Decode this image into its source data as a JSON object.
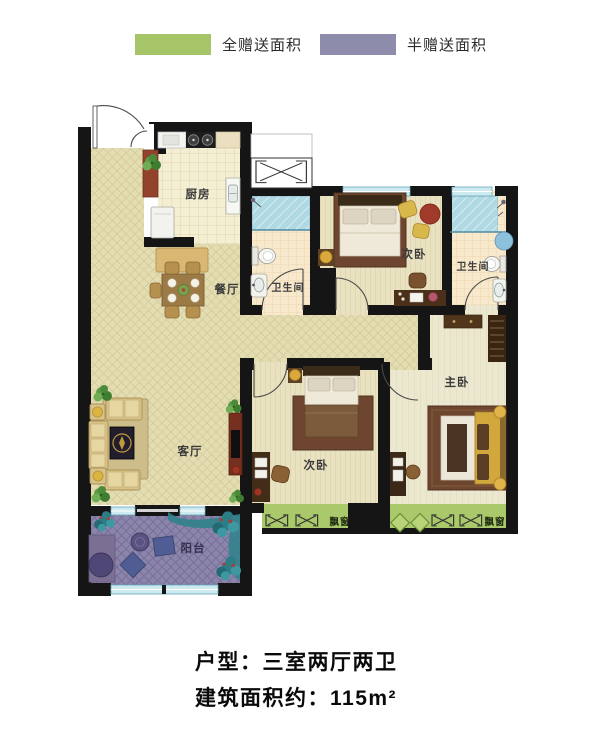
{
  "legend": {
    "full": {
      "label": "全赠送面积",
      "color": "#a6c468"
    },
    "half": {
      "label": "半赠送面积",
      "color": "#8d8cab"
    }
  },
  "floorplan": {
    "rooms": {
      "kitchen": "厨房",
      "dining": "餐厅",
      "living": "客厅",
      "balcony": "阳台",
      "bedroom_top": "次卧",
      "bedroom_mid": "次卧",
      "master": "主卧",
      "bath_left": "卫生间",
      "bath_right": "卫生间",
      "bay_left": "飘窗",
      "bay_right": "飘窗"
    },
    "wall_color": "#151515",
    "full_gift_color": "#a9c96b",
    "half_gift_color": "#8b85aa"
  },
  "footer": {
    "layout_line": "户型：三室两厅两卫",
    "area_line": "建筑面积约：115m²"
  }
}
